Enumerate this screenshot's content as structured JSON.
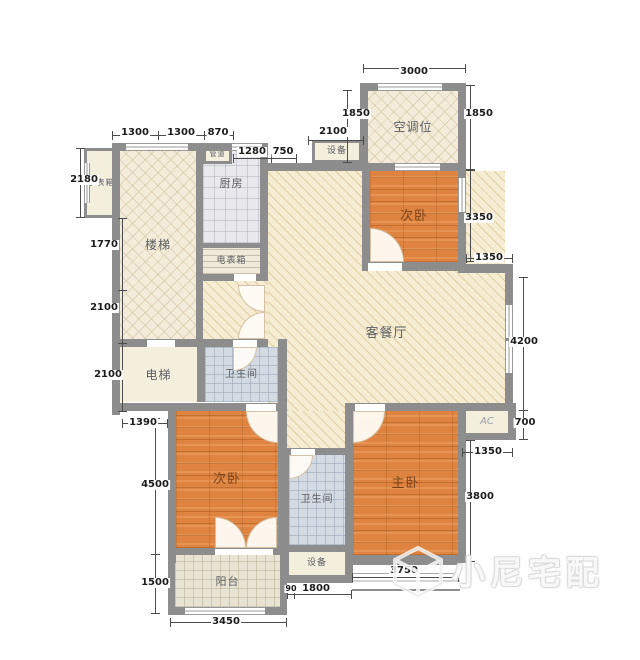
{
  "title": "apartment-floor-plan",
  "watermark": {
    "text": "小尼宅配"
  },
  "colors": {
    "wall": "#8d8d8d",
    "room_cream": "#f6ecd2",
    "bedroom_orange": "#df8340",
    "tile_gray": "#e9e9ed",
    "bath_blue": "#d3dae2",
    "balcony_beige": "#e8e3d2",
    "dim_text": "#1c1c1c"
  },
  "rooms": [
    {
      "name": "living-dining-room",
      "label": "客餐厅",
      "x": 268,
      "y": 171,
      "w": 237,
      "h": 240,
      "kind": "hatch",
      "fs": 13,
      "dy": 42
    },
    {
      "name": "corridor",
      "label": "",
      "x": 203,
      "y": 281,
      "w": 65,
      "h": 58,
      "kind": "hatch",
      "fs": 10
    },
    {
      "name": "hallway",
      "label": "",
      "x": 287,
      "y": 411,
      "w": 58,
      "h": 44,
      "kind": "hatch",
      "fs": 10
    },
    {
      "name": "stairs",
      "label": "楼梯",
      "x": 120,
      "y": 151,
      "w": 76,
      "h": 188,
      "kind": "diamond",
      "fs": 12
    },
    {
      "name": "ac-bay",
      "label": "空调位",
      "x": 368,
      "y": 91,
      "w": 90,
      "h": 72,
      "kind": "diamond",
      "fs": 12
    },
    {
      "name": "bedroom-2-north",
      "label": "次卧",
      "x": 370,
      "y": 171,
      "w": 88,
      "h": 91,
      "kind": "wood",
      "fs": 13
    },
    {
      "name": "bedroom-2-south",
      "label": "次卧",
      "x": 176,
      "y": 411,
      "w": 102,
      "h": 137,
      "kind": "wood",
      "fs": 13
    },
    {
      "name": "master-bedroom",
      "label": "主卧",
      "x": 353,
      "y": 411,
      "w": 105,
      "h": 144,
      "kind": "wood",
      "fs": 13
    },
    {
      "name": "kitchen",
      "label": "厨房",
      "x": 203,
      "y": 151,
      "w": 57,
      "h": 92,
      "kind": "tile",
      "fs": 11,
      "dy": -14
    },
    {
      "name": "electric-meter-box",
      "label": "电表箱",
      "x": 203,
      "y": 248,
      "w": 57,
      "h": 26,
      "kind": "treads",
      "fs": 9
    },
    {
      "name": "elevator",
      "label": "电梯",
      "x": 120,
      "y": 347,
      "w": 77,
      "h": 55,
      "kind": "plain",
      "fs": 12
    },
    {
      "name": "bathroom-1",
      "label": "卫生间",
      "x": 205,
      "y": 347,
      "w": 73,
      "h": 55,
      "kind": "bath",
      "fs": 10
    },
    {
      "name": "bathroom-2",
      "label": "卫生间",
      "x": 289,
      "y": 455,
      "w": 56,
      "h": 90,
      "kind": "bath",
      "fs": 10
    },
    {
      "name": "balcony",
      "label": "阳台",
      "x": 175,
      "y": 555,
      "w": 105,
      "h": 52,
      "kind": "balcony",
      "fs": 11
    },
    {
      "name": "equipment-south",
      "label": "设备",
      "x": 289,
      "y": 552,
      "w": 56,
      "h": 23,
      "kind": "plain",
      "fs": 9
    },
    {
      "name": "equipment-north",
      "label": "设备",
      "x": 312,
      "y": 140,
      "w": 50,
      "h": 23,
      "kind": "plain",
      "fs": 9,
      "border": 1
    },
    {
      "name": "pipe-duct",
      "label": "管道",
      "x": 203,
      "y": 145,
      "w": 29,
      "h": 19,
      "kind": "plain",
      "fs": 7,
      "border": 1
    },
    {
      "name": "water-meter-box",
      "label": "水表箱",
      "x": 84,
      "y": 148,
      "w": 34,
      "h": 70,
      "kind": "plain",
      "fs": 8,
      "border": 1
    },
    {
      "name": "ac-unit",
      "label": "AC",
      "x": 466,
      "y": 411,
      "w": 42,
      "h": 22,
      "kind": "plain",
      "fs": 10,
      "lc": "lite"
    },
    {
      "name": "master-bay-window",
      "label": "",
      "x": 352,
      "y": 563,
      "w": 108,
      "h": 24,
      "kind": "sill"
    }
  ],
  "walls": [
    [
      112,
      143,
      8,
      272
    ],
    [
      112,
      143,
      156,
      8
    ],
    [
      196,
      151,
      7,
      196
    ],
    [
      260,
      143,
      8,
      138
    ],
    [
      203,
      243,
      57,
      5
    ],
    [
      203,
      274,
      57,
      7
    ],
    [
      112,
      339,
      156,
      8
    ],
    [
      197,
      347,
      8,
      55
    ],
    [
      278,
      339,
      9,
      72
    ],
    [
      112,
      403,
      175,
      8
    ],
    [
      345,
      403,
      171,
      8
    ],
    [
      168,
      403,
      8,
      160
    ],
    [
      278,
      403,
      9,
      152
    ],
    [
      281,
      448,
      8,
      135
    ],
    [
      281,
      448,
      71,
      7
    ],
    [
      345,
      403,
      8,
      180
    ],
    [
      281,
      545,
      72,
      7
    ],
    [
      281,
      575,
      72,
      8
    ],
    [
      168,
      548,
      119,
      7
    ],
    [
      168,
      555,
      7,
      60
    ],
    [
      280,
      555,
      7,
      60
    ],
    [
      168,
      607,
      119,
      8
    ],
    [
      345,
      555,
      121,
      8
    ],
    [
      458,
      403,
      8,
      38
    ],
    [
      458,
      433,
      58,
      7
    ],
    [
      508,
      403,
      8,
      37
    ],
    [
      458,
      440,
      8,
      123
    ],
    [
      505,
      270,
      8,
      141
    ],
    [
      458,
      264,
      55,
      9
    ],
    [
      362,
      262,
      104,
      9
    ],
    [
      362,
      163,
      8,
      108
    ],
    [
      458,
      163,
      8,
      110
    ],
    [
      260,
      163,
      206,
      8
    ],
    [
      360,
      83,
      8,
      88
    ],
    [
      360,
      83,
      106,
      8
    ],
    [
      458,
      83,
      8,
      88
    ]
  ],
  "windows": [
    {
      "x": 126,
      "y": 143,
      "w": 62,
      "h": 8,
      "o": "h"
    },
    {
      "x": 232,
      "y": 143,
      "w": 30,
      "h": 8,
      "o": "h"
    },
    {
      "x": 378,
      "y": 83,
      "w": 64,
      "h": 8,
      "o": "h"
    },
    {
      "x": 395,
      "y": 163,
      "w": 45,
      "h": 8,
      "o": "h"
    },
    {
      "x": 185,
      "y": 607,
      "w": 80,
      "h": 8,
      "o": "h"
    },
    {
      "x": 505,
      "y": 305,
      "w": 8,
      "h": 33,
      "o": "v"
    },
    {
      "x": 505,
      "y": 341,
      "w": 8,
      "h": 32,
      "o": "v"
    },
    {
      "x": 458,
      "y": 178,
      "w": 8,
      "h": 34,
      "o": "v"
    },
    {
      "x": 84,
      "y": 163,
      "w": 6,
      "h": 40,
      "o": "v"
    }
  ],
  "gaps": [
    [
      368,
      263,
      34,
      8
    ],
    [
      355,
      404,
      30,
      7
    ],
    [
      246,
      404,
      30,
      7
    ],
    [
      291,
      449,
      24,
      6
    ],
    [
      233,
      340,
      24,
      7
    ],
    [
      215,
      549,
      58,
      6
    ],
    [
      147,
      340,
      28,
      7
    ],
    [
      234,
      274,
      22,
      7
    ]
  ],
  "doors": [
    {
      "x": 370,
      "y": 228,
      "s": 34,
      "arc": "tr"
    },
    {
      "x": 246,
      "y": 411,
      "s": 32,
      "arc": "bl"
    },
    {
      "x": 353,
      "y": 411,
      "s": 32,
      "arc": "br"
    },
    {
      "x": 289,
      "y": 455,
      "s": 24,
      "arc": "br"
    },
    {
      "x": 233,
      "y": 347,
      "s": 24,
      "arc": "br"
    },
    {
      "x": 238,
      "y": 285,
      "s": 27,
      "arc": "bl"
    },
    {
      "x": 238,
      "y": 312,
      "s": 27,
      "arc": "tl"
    },
    {
      "x": 215,
      "y": 517,
      "s": 31,
      "arc": "tr"
    },
    {
      "x": 246,
      "y": 517,
      "s": 31,
      "arc": "tl"
    }
  ],
  "lines": [
    [
      363,
      68,
      103,
      1
    ],
    [
      363,
      64,
      1,
      9
    ],
    [
      465,
      64,
      1,
      9
    ],
    [
      347,
      90,
      1,
      73
    ],
    [
      343,
      90,
      9,
      1
    ],
    [
      343,
      162,
      9,
      1
    ],
    [
      470,
      85,
      1,
      85
    ],
    [
      466,
      85,
      9,
      1
    ],
    [
      466,
      169,
      9,
      1
    ],
    [
      112,
      135,
      122,
      1
    ],
    [
      112,
      131,
      1,
      9
    ],
    [
      158,
      131,
      1,
      9
    ],
    [
      204,
      131,
      1,
      9
    ],
    [
      233,
      131,
      1,
      9
    ],
    [
      233,
      158,
      64,
      1
    ],
    [
      233,
      154,
      1,
      9
    ],
    [
      271,
      154,
      1,
      9
    ],
    [
      296,
      154,
      1,
      9
    ],
    [
      308,
      140,
      56,
      1
    ],
    [
      308,
      136,
      1,
      9
    ],
    [
      363,
      136,
      1,
      9
    ],
    [
      80,
      148,
      1,
      70
    ],
    [
      76,
      148,
      9,
      1
    ],
    [
      76,
      217,
      9,
      1
    ],
    [
      122,
      218,
      1,
      194
    ],
    [
      118,
      218,
      9,
      1
    ],
    [
      118,
      290,
      9,
      1
    ],
    [
      118,
      343,
      9,
      1
    ],
    [
      118,
      411,
      9,
      1
    ],
    [
      122,
      423,
      46,
      1
    ],
    [
      122,
      419,
      1,
      9
    ],
    [
      167,
      419,
      1,
      9
    ],
    [
      155,
      418,
      1,
      196
    ],
    [
      151,
      418,
      9,
      1
    ],
    [
      151,
      554,
      9,
      1
    ],
    [
      151,
      613,
      9,
      1
    ],
    [
      170,
      622,
      117,
      1
    ],
    [
      170,
      618,
      1,
      9
    ],
    [
      286,
      618,
      1,
      9
    ],
    [
      287,
      594,
      65,
      1
    ],
    [
      287,
      590,
      1,
      9
    ],
    [
      294,
      590,
      1,
      9
    ],
    [
      351,
      590,
      1,
      9
    ],
    [
      352,
      577,
      107,
      1
    ],
    [
      352,
      573,
      1,
      9
    ],
    [
      458,
      573,
      1,
      9
    ],
    [
      470,
      170,
      1,
      92
    ],
    [
      466,
      170,
      9,
      1
    ],
    [
      466,
      261,
      9,
      1
    ],
    [
      466,
      258,
      47,
      1
    ],
    [
      466,
      254,
      1,
      9
    ],
    [
      512,
      254,
      1,
      9
    ],
    [
      523,
      277,
      1,
      163
    ],
    [
      519,
      277,
      9,
      1
    ],
    [
      519,
      410,
      9,
      1
    ],
    [
      519,
      439,
      9,
      1
    ],
    [
      462,
      452,
      51,
      1
    ],
    [
      462,
      448,
      1,
      9
    ],
    [
      512,
      448,
      1,
      9
    ],
    [
      470,
      440,
      1,
      122
    ],
    [
      466,
      440,
      9,
      1
    ],
    [
      466,
      561,
      9,
      1
    ]
  ],
  "dims": [
    {
      "t": "3000",
      "x": 414,
      "y": 72
    },
    {
      "t": "1850",
      "x": 356,
      "y": 114
    },
    {
      "t": "1850",
      "x": 479,
      "y": 114
    },
    {
      "t": "1300",
      "x": 135,
      "y": 133
    },
    {
      "t": "1300",
      "x": 181,
      "y": 133
    },
    {
      "t": "870",
      "x": 218,
      "y": 133
    },
    {
      "t": "1280",
      "x": 252,
      "y": 152
    },
    {
      "t": "750",
      "x": 283,
      "y": 152
    },
    {
      "t": "2100",
      "x": 333,
      "y": 132
    },
    {
      "t": "2180",
      "x": 84,
      "y": 180
    },
    {
      "t": "1770",
      "x": 104,
      "y": 245
    },
    {
      "t": "2100",
      "x": 104,
      "y": 308
    },
    {
      "t": "2100",
      "x": 108,
      "y": 375
    },
    {
      "t": "1390",
      "x": 143,
      "y": 423
    },
    {
      "t": "4500",
      "x": 155,
      "y": 485
    },
    {
      "t": "1500",
      "x": 155,
      "y": 583
    },
    {
      "t": "3450",
      "x": 226,
      "y": 622
    },
    {
      "t": "90",
      "x": 291,
      "y": 589,
      "fs": 8
    },
    {
      "t": "1800",
      "x": 316,
      "y": 589
    },
    {
      "t": "3750",
      "x": 404,
      "y": 571
    },
    {
      "t": "3350",
      "x": 479,
      "y": 218
    },
    {
      "t": "1350",
      "x": 489,
      "y": 258
    },
    {
      "t": "4200",
      "x": 524,
      "y": 342
    },
    {
      "t": "700",
      "x": 525,
      "y": 423
    },
    {
      "t": "1350",
      "x": 488,
      "y": 452
    },
    {
      "t": "3800",
      "x": 480,
      "y": 497
    }
  ]
}
